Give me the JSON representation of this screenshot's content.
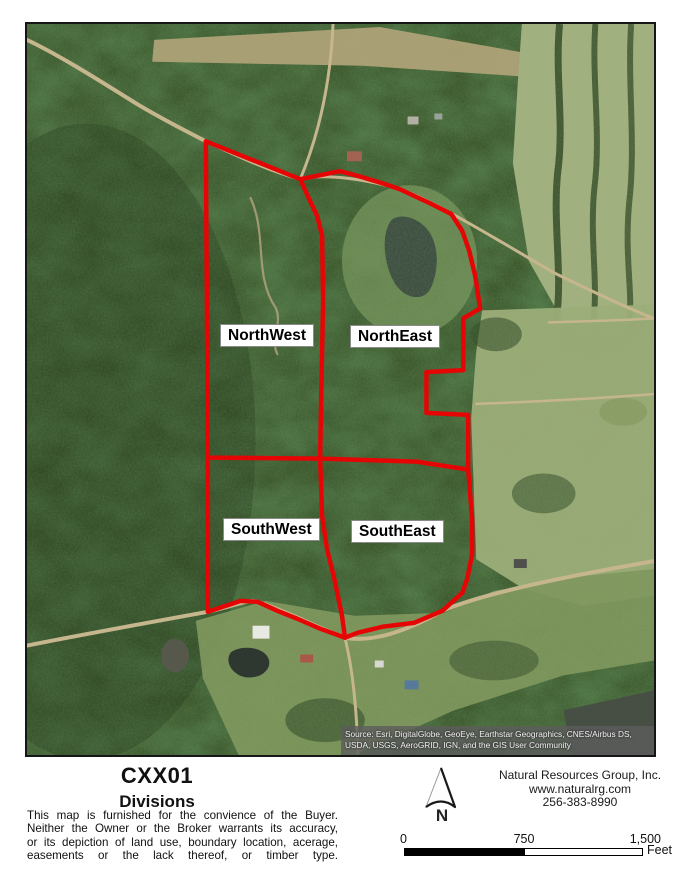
{
  "map": {
    "parcels": [
      {
        "label": "NorthWest"
      },
      {
        "label": "NorthEast"
      },
      {
        "label": "SouthWest"
      },
      {
        "label": "SouthEast"
      }
    ],
    "attribution": "Source: Esri, DigitalGlobe, GeoEye, Earthstar Geographics, CNES/Airbus DS, USDA, USGS, AeroGRID, IGN, and the GIS User Community",
    "boundary_color": "#e60505"
  },
  "footer": {
    "title": "CXX01",
    "subtitle": "Divisions",
    "disclaimer_lines": [
      "This map is furnished for the convience of the Buyer.",
      "Neither the Owner or the Broker warrants its accuracy,",
      "or its depiction of land use, boundary location, acerage,",
      "easements or the lack thereof, or timber type."
    ],
    "company": {
      "name": "Natural Resources Group, Inc.",
      "website": "www.naturalrg.com",
      "phone": "256-383-8990"
    },
    "north_arrow_label": "N",
    "scale_bar": {
      "tick_start": "0",
      "tick_mid": "750",
      "tick_end": "1,500",
      "unit": "Feet"
    }
  }
}
